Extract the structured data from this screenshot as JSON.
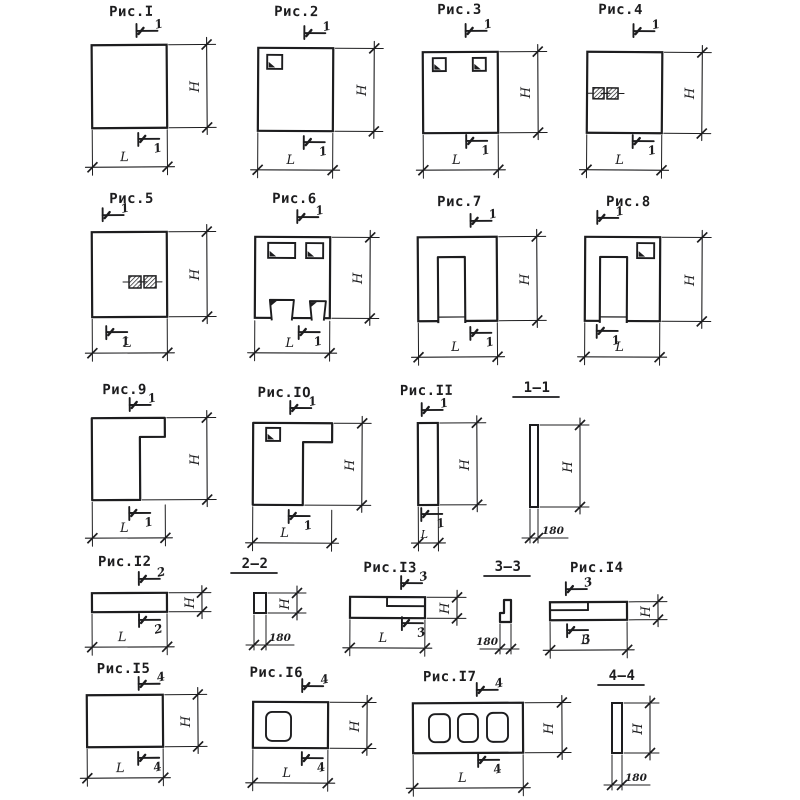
{
  "page": {
    "background": "#ffffff",
    "ink": "#1d1d1f"
  },
  "dim_labels": {
    "h": "H",
    "l": "L"
  },
  "figures": [
    {
      "id": "ris-1",
      "title": "Рис.I",
      "cut": "1"
    },
    {
      "id": "ris-2",
      "title": "Рис.2",
      "cut": "1"
    },
    {
      "id": "ris-3",
      "title": "Рис.3",
      "cut": "1"
    },
    {
      "id": "ris-4",
      "title": "Рис.4",
      "cut": "1"
    },
    {
      "id": "ris-5",
      "title": "Рис.5",
      "cut": "1"
    },
    {
      "id": "ris-6",
      "title": "Рис.6",
      "cut": "1"
    },
    {
      "id": "ris-7",
      "title": "Рис.7",
      "cut": "1"
    },
    {
      "id": "ris-8",
      "title": "Рис.8",
      "cut": "1"
    },
    {
      "id": "ris-9",
      "title": "Рис.9",
      "cut": "1"
    },
    {
      "id": "ris-10",
      "title": "Рис.IO",
      "cut": "1"
    },
    {
      "id": "ris-11",
      "title": "Рис.II",
      "cut": "1"
    },
    {
      "id": "ris-12",
      "title": "Рис.I2",
      "cut": "2"
    },
    {
      "id": "ris-13",
      "title": "Рис.I3",
      "cut": "3"
    },
    {
      "id": "ris-14",
      "title": "Рис.I4",
      "cut": "3"
    },
    {
      "id": "ris-15",
      "title": "Рис.I5",
      "cut": "4"
    },
    {
      "id": "ris-16",
      "title": "Рис.I6",
      "cut": "4"
    },
    {
      "id": "ris-17",
      "title": "Рис.I7",
      "cut": "4"
    }
  ],
  "sections": [
    {
      "id": "section-1-1",
      "title": "1—1",
      "thickness": "180"
    },
    {
      "id": "section-2-2",
      "title": "2—2",
      "thickness": "180"
    },
    {
      "id": "section-3-3",
      "title": "3—3",
      "thickness": "180"
    },
    {
      "id": "section-4-4",
      "title": "4—4",
      "thickness": "180"
    }
  ]
}
